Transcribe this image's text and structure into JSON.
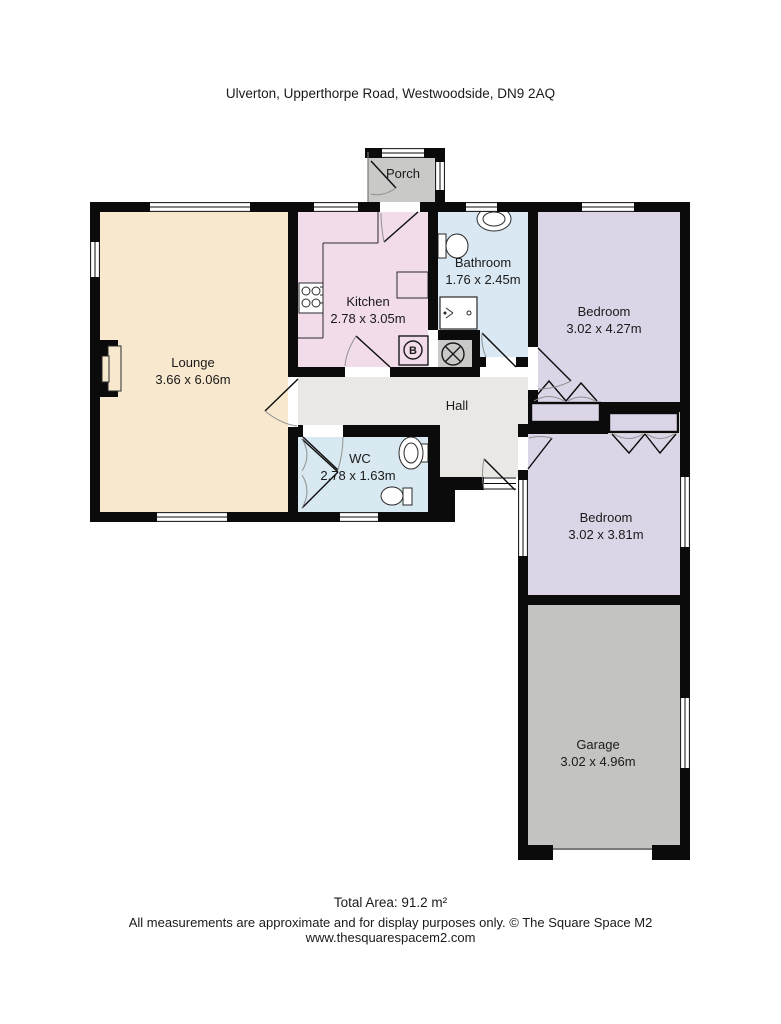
{
  "title": "Ulverton, Upperthorpe Road, Westwoodside, DN9 2AQ",
  "rooms": {
    "porch": {
      "name": "Porch"
    },
    "kitchen": {
      "name": "Kitchen",
      "dims": "2.78 x 3.05m"
    },
    "bathroom": {
      "name": "Bathroom",
      "dims": "1.76 x 2.45m"
    },
    "bedroom1": {
      "name": "Bedroom",
      "dims": "3.02 x 4.27m"
    },
    "lounge": {
      "name": "Lounge",
      "dims": "3.66 x 6.06m"
    },
    "hall": {
      "name": "Hall"
    },
    "wc": {
      "name": "WC",
      "dims": "2.78 x 1.63m"
    },
    "bedroom2": {
      "name": "Bedroom",
      "dims": "3.02 x 3.81m"
    },
    "garage": {
      "name": "Garage",
      "dims": "3.02 x 4.96m"
    }
  },
  "symbols": {
    "boiler": "B"
  },
  "footer": {
    "total_area": "Total Area: 91.2 m²",
    "disclaimer": "All measurements are approximate and for display purposes only. © The Square Space M2",
    "website": "www.thesquarespacem2.com"
  },
  "colors": {
    "wall": "#0b0b0b",
    "lounge": "#f8e8ce",
    "kitchen": "#f3dce9",
    "bathroom": "#d9e8f3",
    "wc": "#d9e9f1",
    "bedroom": "#dcd5e7",
    "hall": "#e9e8e5",
    "porch": "#c9c9c8",
    "garage": "#c3c3c1"
  }
}
